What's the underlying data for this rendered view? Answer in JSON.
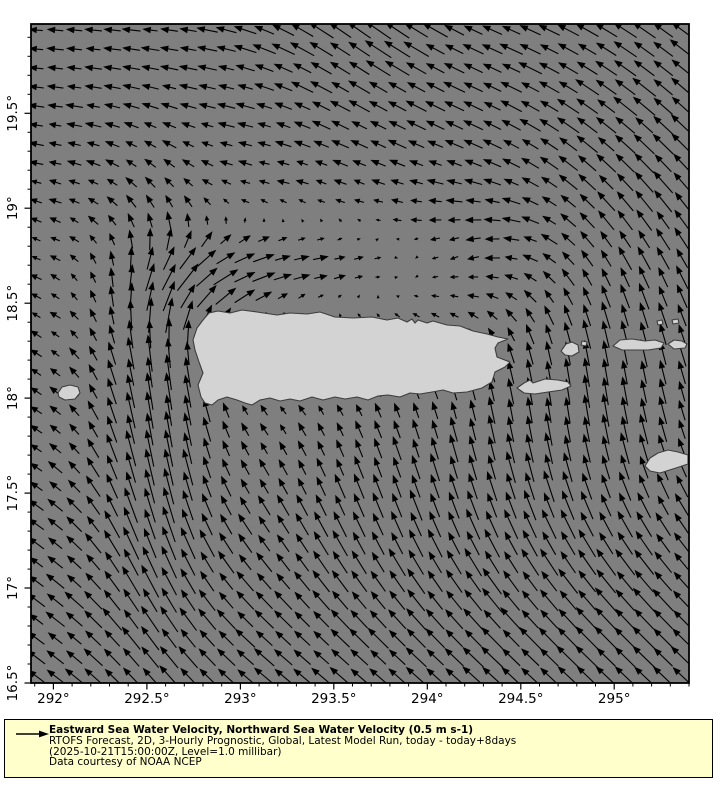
{
  "chart_data": {
    "type": "quiver",
    "title": "",
    "xlabel": "",
    "ylabel": "",
    "x_axis": {
      "min": 291.88,
      "max": 295.4,
      "major_tick_values": [
        292,
        292.5,
        293,
        293.5,
        294,
        294.5,
        295
      ],
      "major_tick_labels": [
        "292°",
        "292.5°",
        "293°",
        "293.5°",
        "294°",
        "294.5°",
        "295°"
      ],
      "minor_tick_step": 0.1
    },
    "y_axis": {
      "min": 16.5,
      "max": 19.97,
      "major_tick_values": [
        16.5,
        17,
        17.5,
        18,
        18.5,
        19,
        19.5
      ],
      "major_tick_labels": [
        "16.5°",
        "17°",
        "17.5°",
        "18°",
        "18.5°",
        "19°",
        "19.5°"
      ],
      "minor_tick_step": 0.1
    },
    "reference_arrow": {
      "speed_label": "0.5 m s-1",
      "speed_ms": 0.5,
      "px_per_ms": 50
    },
    "arrow_grid_step_px": 19,
    "background_flow": {
      "u": -0.05,
      "v": 0.01
    },
    "flow_features": [
      {
        "name": "north-band-westward",
        "cx": 293.4,
        "cy": 19.95,
        "sx": 2.0,
        "sy": 0.7,
        "u": -0.32,
        "v": 0.0
      },
      {
        "name": "top-center-northwest",
        "cx": 293.6,
        "cy": 20.15,
        "sx": 0.42,
        "sy": 0.55,
        "u": -0.1,
        "v": 0.32
      },
      {
        "name": "top-right-northwest",
        "cx": 295.55,
        "cy": 19.4,
        "sx": 0.85,
        "sy": 0.9,
        "u": -0.22,
        "v": 0.38
      },
      {
        "name": "mona-passage-northward-jet",
        "cx": 292.55,
        "cy": 17.95,
        "sx": 0.23,
        "sy": 0.75,
        "u": 0.04,
        "v": 0.65
      },
      {
        "name": "mona-outflow-northeast",
        "cx": 292.85,
        "cy": 18.62,
        "sx": 0.3,
        "sy": 0.18,
        "u": 0.45,
        "v": 0.18
      },
      {
        "name": "north-coast-eastward",
        "cx": 293.45,
        "cy": 18.72,
        "sx": 0.5,
        "sy": 0.15,
        "u": 0.38,
        "v": 0.0
      },
      {
        "name": "northeast-coast-southwest",
        "cx": 294.3,
        "cy": 18.72,
        "sx": 0.35,
        "sy": 0.28,
        "u": -0.2,
        "v": -0.26
      },
      {
        "name": "east-northward-flow",
        "cx": 294.85,
        "cy": 18.05,
        "sx": 0.55,
        "sy": 0.55,
        "u": 0.08,
        "v": 0.42
      },
      {
        "name": "south-of-vieques-northward",
        "cx": 293.8,
        "cy": 17.45,
        "sx": 0.6,
        "sy": 0.38,
        "u": 0.02,
        "v": 0.3
      },
      {
        "name": "south-northwest-drift",
        "cx": 293.1,
        "cy": 16.6,
        "sx": 1.4,
        "sy": 0.8,
        "u": -0.3,
        "v": 0.27
      },
      {
        "name": "bottom-right-northwest",
        "cx": 295.4,
        "cy": 16.7,
        "sx": 0.9,
        "sy": 0.7,
        "u": -0.28,
        "v": 0.3
      },
      {
        "name": "west-edge-drift",
        "cx": 291.9,
        "cy": 17.9,
        "sx": 0.45,
        "sy": 1.2,
        "u": -0.12,
        "v": 0.08
      }
    ]
  },
  "colors": {
    "ocean": "#7f7f7f",
    "land": "#d3d3d3",
    "land_edge": "#3d3d3d",
    "arrow": "#000000",
    "frame": "#000000",
    "text": "#000000",
    "legend_bg": "#ffffcc",
    "legend_border": "#000000",
    "page_bg": "#ffffff"
  },
  "map": {
    "units": "plot pixels",
    "islands": [
      {
        "name": "puerto-rico",
        "points": [
          [
            209,
            313
          ],
          [
            218,
            311
          ],
          [
            230,
            313
          ],
          [
            242,
            310
          ],
          [
            257,
            312
          ],
          [
            277,
            315
          ],
          [
            290,
            313
          ],
          [
            307,
            314
          ],
          [
            320,
            312
          ],
          [
            335,
            317
          ],
          [
            353,
            318
          ],
          [
            372,
            317
          ],
          [
            387,
            320
          ],
          [
            398,
            318
          ],
          [
            407,
            322
          ],
          [
            412,
            319
          ],
          [
            415,
            323
          ],
          [
            418,
            320
          ],
          [
            427,
            323
          ],
          [
            433,
            321
          ],
          [
            447,
            325
          ],
          [
            460,
            326
          ],
          [
            473,
            331
          ],
          [
            487,
            334
          ],
          [
            498,
            337
          ],
          [
            508,
            339
          ],
          [
            498,
            343
          ],
          [
            495,
            348
          ],
          [
            497,
            357
          ],
          [
            510,
            362
          ],
          [
            505,
            367
          ],
          [
            495,
            372
          ],
          [
            492,
            382
          ],
          [
            482,
            388
          ],
          [
            467,
            392
          ],
          [
            453,
            393
          ],
          [
            443,
            390
          ],
          [
            432,
            392
          ],
          [
            420,
            394
          ],
          [
            410,
            393
          ],
          [
            400,
            397
          ],
          [
            388,
            395
          ],
          [
            378,
            396
          ],
          [
            368,
            400
          ],
          [
            357,
            397
          ],
          [
            345,
            399
          ],
          [
            335,
            397
          ],
          [
            323,
            400
          ],
          [
            312,
            397
          ],
          [
            300,
            401
          ],
          [
            290,
            399
          ],
          [
            280,
            401
          ],
          [
            270,
            398
          ],
          [
            260,
            400
          ],
          [
            252,
            405
          ],
          [
            245,
            403
          ],
          [
            237,
            400
          ],
          [
            227,
            397
          ],
          [
            218,
            400
          ],
          [
            212,
            405
          ],
          [
            205,
            403
          ],
          [
            201,
            397
          ],
          [
            198,
            385
          ],
          [
            203,
            373
          ],
          [
            199,
            362
          ],
          [
            195,
            350
          ],
          [
            193,
            340
          ],
          [
            197,
            328
          ],
          [
            203,
            320
          ]
        ]
      },
      {
        "name": "mona-island",
        "points": [
          [
            58,
            393
          ],
          [
            62,
            387
          ],
          [
            70,
            385
          ],
          [
            78,
            387
          ],
          [
            80,
            393
          ],
          [
            75,
            399
          ],
          [
            65,
            400
          ],
          [
            59,
            397
          ]
        ]
      },
      {
        "name": "vieques",
        "points": [
          [
            517,
            388
          ],
          [
            524,
            383
          ],
          [
            530,
            380
          ],
          [
            533,
            383
          ],
          [
            545,
            379
          ],
          [
            558,
            380
          ],
          [
            568,
            382
          ],
          [
            571,
            386
          ],
          [
            562,
            390
          ],
          [
            548,
            392
          ],
          [
            535,
            394
          ],
          [
            524,
            393
          ]
        ]
      },
      {
        "name": "culebra",
        "points": [
          [
            561,
            351
          ],
          [
            566,
            344
          ],
          [
            572,
            342
          ],
          [
            578,
            345
          ],
          [
            579,
            352
          ],
          [
            572,
            356
          ],
          [
            565,
            355
          ]
        ]
      },
      {
        "name": "culebra-speck",
        "points": [
          [
            582,
            341
          ],
          [
            587,
            342
          ],
          [
            586,
            346
          ],
          [
            581,
            345
          ]
        ]
      },
      {
        "name": "st-thomas-st-john-tortola",
        "points": [
          [
            613,
            346
          ],
          [
            620,
            340
          ],
          [
            632,
            339
          ],
          [
            645,
            341
          ],
          [
            655,
            340
          ],
          [
            664,
            343
          ],
          [
            661,
            348
          ],
          [
            648,
            350
          ],
          [
            635,
            350
          ],
          [
            622,
            350
          ]
        ]
      },
      {
        "name": "virgin-gorda",
        "points": [
          [
            668,
            344
          ],
          [
            674,
            340
          ],
          [
            682,
            341
          ],
          [
            687,
            344
          ],
          [
            685,
            348
          ],
          [
            674,
            349
          ]
        ]
      },
      {
        "name": "islet-speck-1",
        "points": [
          [
            657,
            321
          ],
          [
            662,
            320
          ],
          [
            663,
            324
          ],
          [
            658,
            325
          ]
        ]
      },
      {
        "name": "islet-speck-2",
        "points": [
          [
            672,
            320
          ],
          [
            678,
            319
          ],
          [
            679,
            323
          ],
          [
            673,
            324
          ]
        ]
      },
      {
        "name": "st-croix",
        "points": [
          [
            645,
            466
          ],
          [
            650,
            458
          ],
          [
            658,
            453
          ],
          [
            668,
            450
          ],
          [
            678,
            452
          ],
          [
            688,
            455
          ],
          [
            688,
            464
          ],
          [
            676,
            468
          ],
          [
            660,
            473
          ],
          [
            650,
            471
          ]
        ]
      }
    ]
  },
  "legend": {
    "title": "Eastward Sea Water Velocity, Northward Sea Water Velocity (0.5 m s-1)",
    "subtitle1": "RTOFS Forecast, 2D, 3-Hourly Prognostic, Global, Latest Model Run, today - today+8days",
    "subtitle2": "(2025-10-21T15:00:00Z, Level=1.0 millibar)",
    "subtitle3": "Data courtesy of NOAA NCEP"
  }
}
